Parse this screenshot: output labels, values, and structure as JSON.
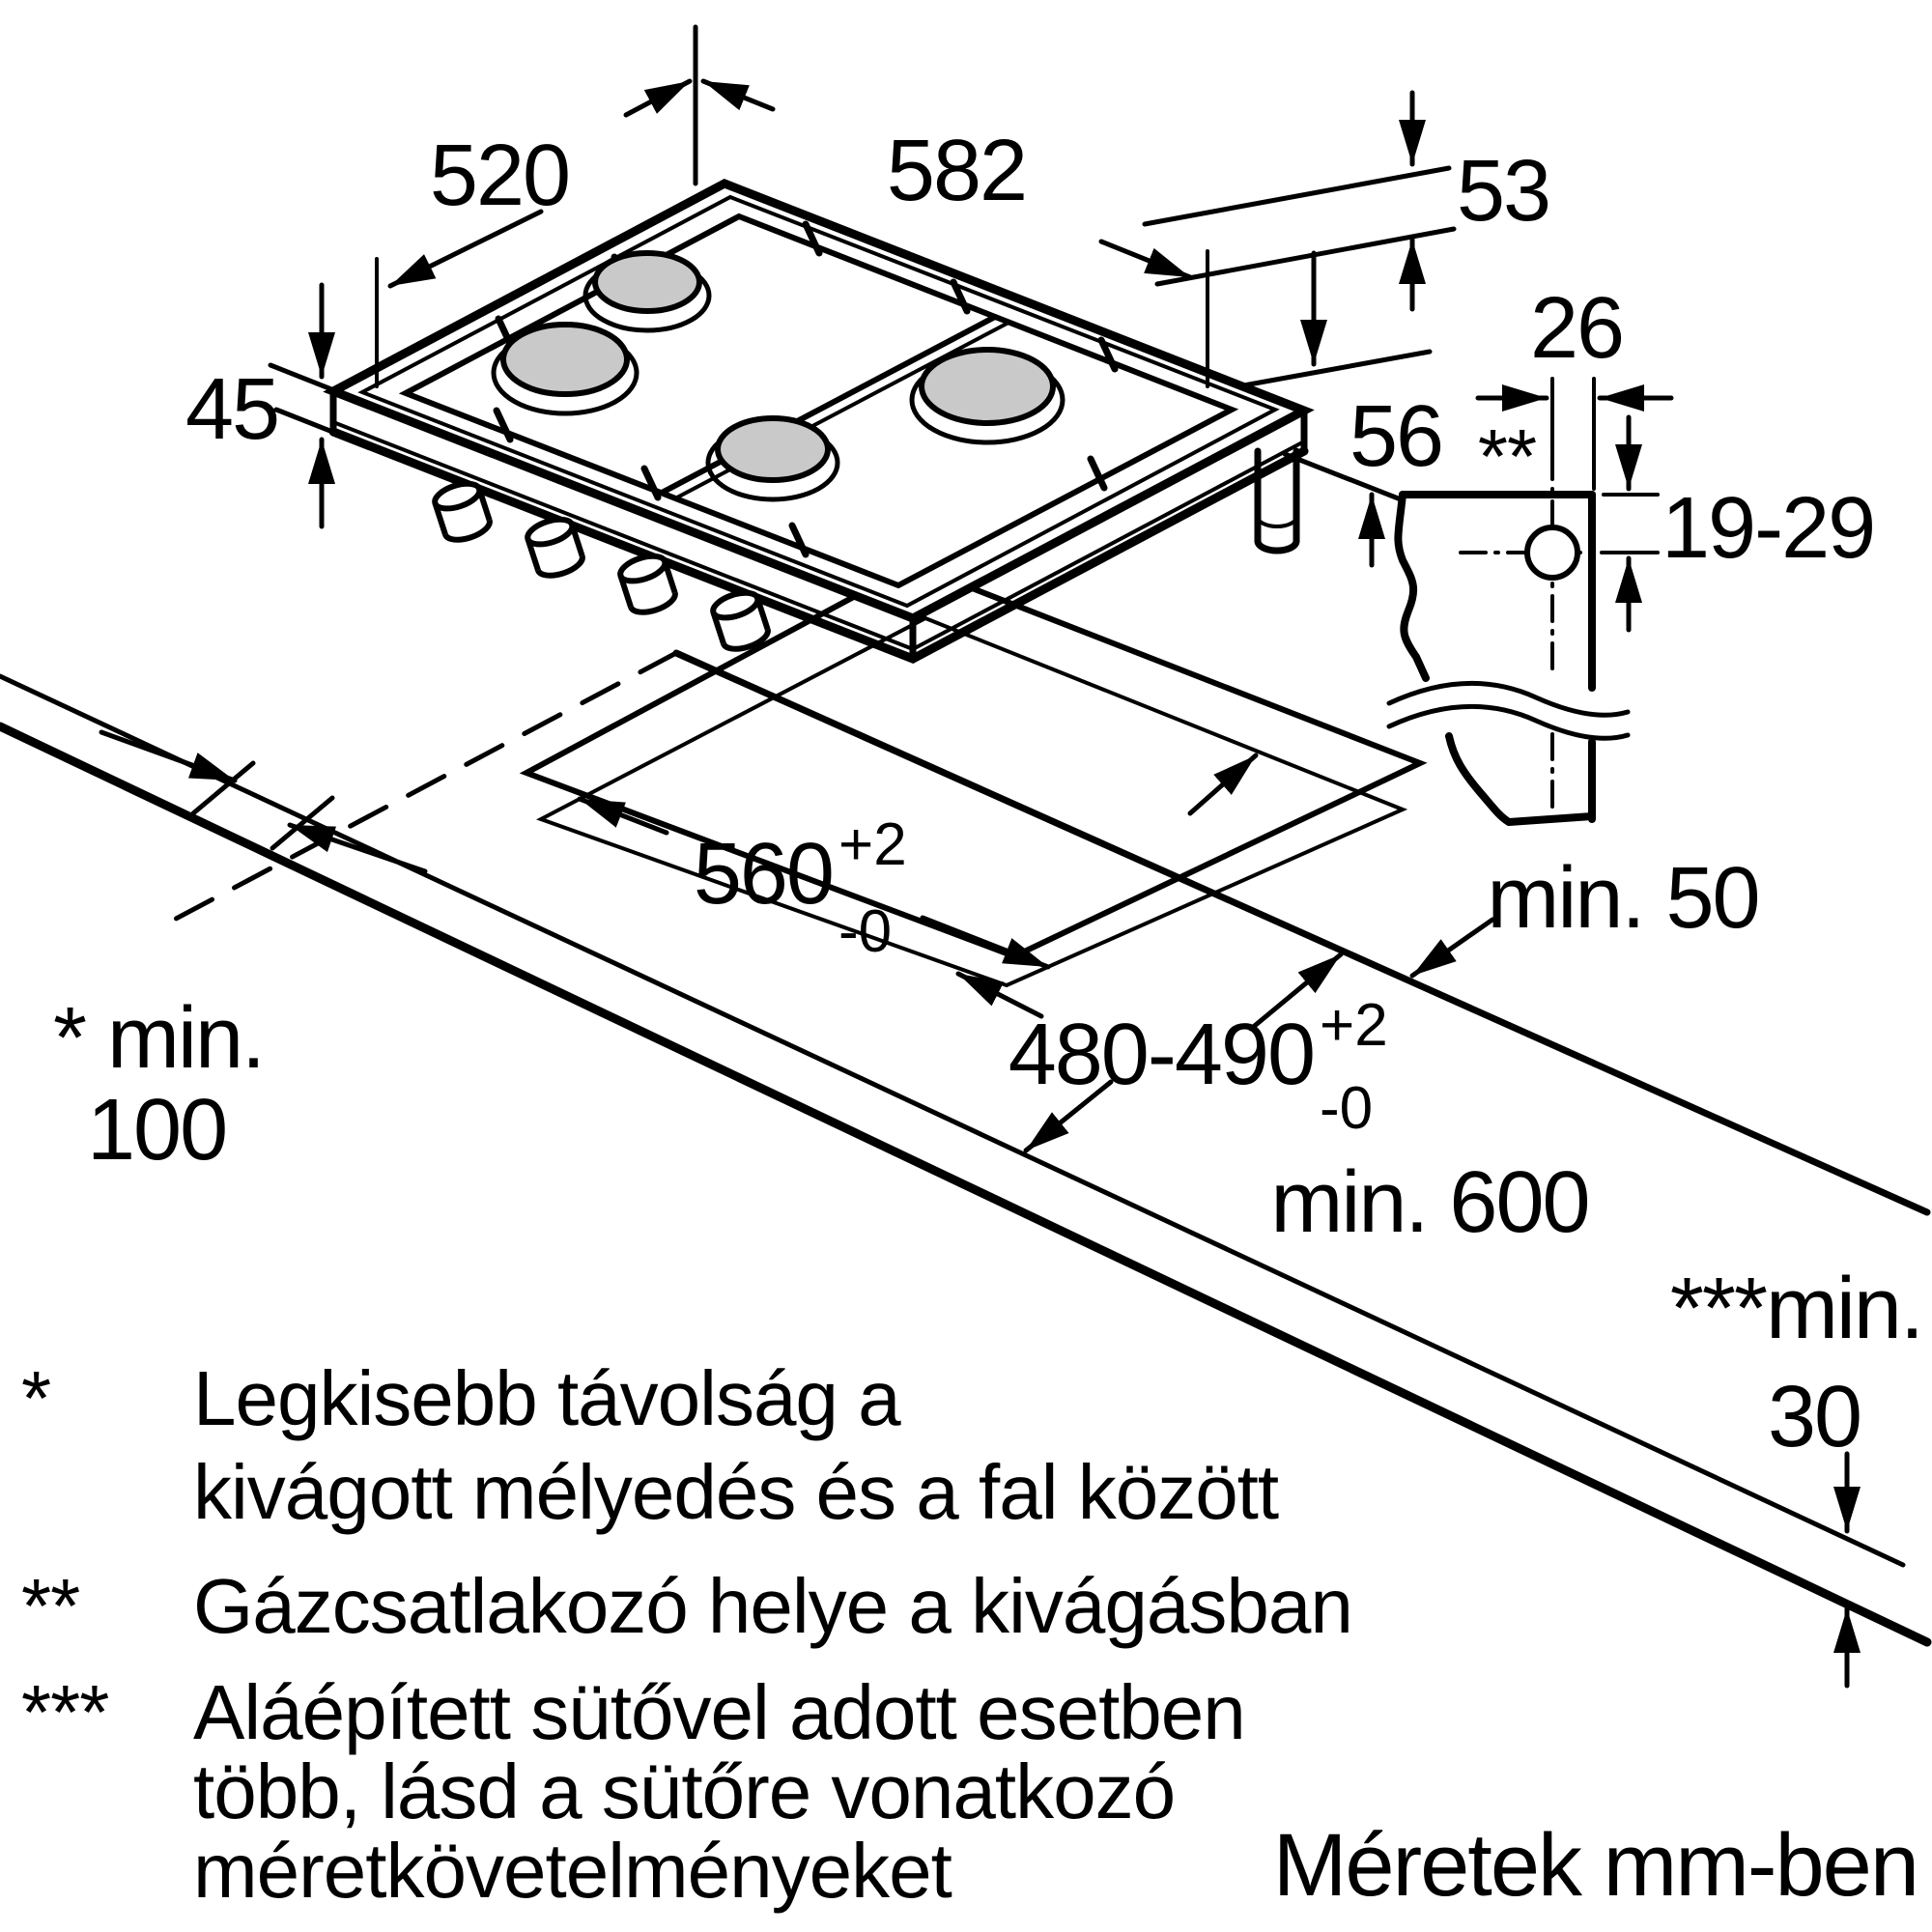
{
  "dimensions": {
    "hob_depth": "520",
    "hob_width": "582",
    "edge_53": "53",
    "hob_height": "45",
    "edge_56": "56",
    "gas_offset": "26",
    "gas_height_range": "19-29",
    "cutout_width": "560",
    "cutout_width_tol_plus": "+2",
    "cutout_width_tol_minus": "-0",
    "cutout_depth": "480-490",
    "cutout_depth_tol_plus": "+2",
    "cutout_depth_tol_minus": "-0"
  },
  "clearances": {
    "back": "min. 50",
    "side_label": "* min.",
    "side_value": "100",
    "front": "min. 600",
    "oven_label": "***min.",
    "oven_value": "30"
  },
  "gas_marker": "**",
  "footnotes": [
    {
      "marker": "*",
      "lines": [
        "Legkisebb távolság a",
        "kivágott mélyedés és a fal között"
      ]
    },
    {
      "marker": "**",
      "lines": [
        "Gázcsatlakozó helye a kivágásban"
      ]
    },
    {
      "marker": "***",
      "lines": [
        "Aláépített sütővel adott esetben",
        "több, lásd a sütőre vonatkozó",
        "méretkövetelményeket"
      ]
    }
  ],
  "units_note": "Méretek mm-ben"
}
